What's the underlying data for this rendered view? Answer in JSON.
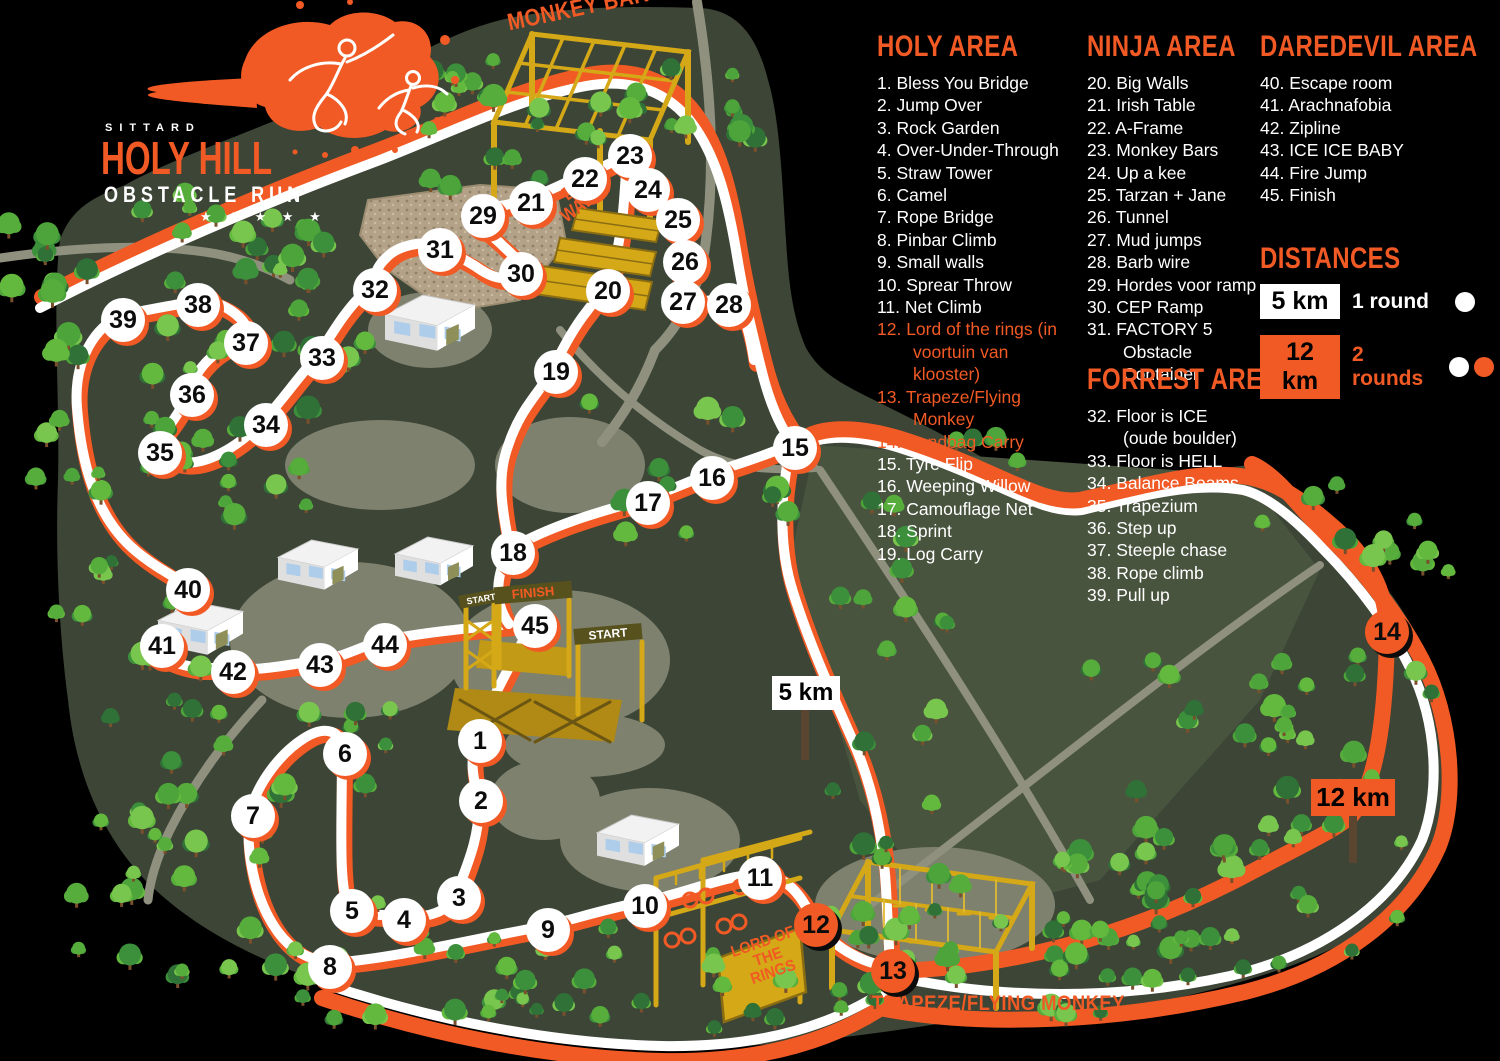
{
  "logo": {
    "city": "SITTARD",
    "title": "HOLY HILL",
    "subtitle": "OBSTACLE RUN",
    "stars": "★ ★ ★ ★ ★"
  },
  "areas": [
    {
      "title": "HOLY AREA",
      "items": [
        {
          "n": "1.",
          "t": "Bless You Bridge",
          "hl": false
        },
        {
          "n": "2.",
          "t": "Jump Over",
          "hl": false
        },
        {
          "n": "3.",
          "t": "Rock Garden",
          "hl": false
        },
        {
          "n": "4.",
          "t": "Over-Under-Through",
          "hl": false
        },
        {
          "n": "5.",
          "t": "Straw Tower",
          "hl": false
        },
        {
          "n": "6.",
          "t": "Camel",
          "hl": false
        },
        {
          "n": "7.",
          "t": "Rope Bridge",
          "hl": false
        },
        {
          "n": "8.",
          "t": "Pinbar Climb",
          "hl": false
        },
        {
          "n": "9.",
          "t": "Small walls",
          "hl": false
        },
        {
          "n": "10.",
          "t": "Sprear Throw",
          "hl": false
        },
        {
          "n": "11.",
          "t": "Net Climb",
          "hl": false
        },
        {
          "n": "12.",
          "t": "Lord of the rings (in voortuin van klooster)",
          "hl": true
        },
        {
          "n": "13.",
          "t": "Trapeze/Flying Monkey",
          "hl": true
        },
        {
          "n": "14.",
          "t": "Sandbag Carry",
          "hl": true
        },
        {
          "n": "15.",
          "t": "Tyre Flip",
          "hl": false
        },
        {
          "n": "16.",
          "t": "Weeping Willow",
          "hl": false
        },
        {
          "n": "17.",
          "t": "Camouflage Net",
          "hl": false
        },
        {
          "n": "18.",
          "t": "Sprint",
          "hl": false
        },
        {
          "n": "19.",
          "t": "Log Carry",
          "hl": false
        }
      ]
    },
    {
      "title": "NINJA AREA",
      "items": [
        {
          "n": "20.",
          "t": "Big Walls",
          "hl": false
        },
        {
          "n": "21.",
          "t": "Irish Table",
          "hl": false
        },
        {
          "n": "22.",
          "t": "A-Frame",
          "hl": false
        },
        {
          "n": "23.",
          "t": "Monkey Bars",
          "hl": false
        },
        {
          "n": "24.",
          "t": "Up a kee",
          "hl": false
        },
        {
          "n": "25.",
          "t": "Tarzan + Jane",
          "hl": false
        },
        {
          "n": "26.",
          "t": "Tunnel",
          "hl": false
        },
        {
          "n": "27.",
          "t": "Mud jumps",
          "hl": false
        },
        {
          "n": "28.",
          "t": "Barb wire",
          "hl": false
        },
        {
          "n": "29.",
          "t": "Hordes voor ramp",
          "hl": false
        },
        {
          "n": "30.",
          "t": "CEP Ramp",
          "hl": false
        },
        {
          "n": "31.",
          "t": "FACTORY 5 Obstacle Container",
          "hl": false
        }
      ]
    },
    {
      "title": "FORREST AREA",
      "items": [
        {
          "n": "32.",
          "t": "Floor is ICE (oude boulder)",
          "hl": false
        },
        {
          "n": "33.",
          "t": "Floor is HELL",
          "hl": false
        },
        {
          "n": "34.",
          "t": "Balance Beams",
          "hl": false
        },
        {
          "n": "35.",
          "t": "Trapezium",
          "hl": false
        },
        {
          "n": "36.",
          "t": "Step up",
          "hl": false
        },
        {
          "n": "37.",
          "t": "Steeple chase",
          "hl": false
        },
        {
          "n": "38.",
          "t": "Rope climb",
          "hl": false
        },
        {
          "n": "39.",
          "t": "Pull up",
          "hl": false
        }
      ]
    },
    {
      "title": "DAREDEVIL AREA",
      "items": [
        {
          "n": "40.",
          "t": "Escape room",
          "hl": false
        },
        {
          "n": "41.",
          "t": "Arachnafobia",
          "hl": false
        },
        {
          "n": "42.",
          "t": "Zipline",
          "hl": false
        },
        {
          "n": "43.",
          "t": "ICE ICE BABY",
          "hl": false
        },
        {
          "n": "44.",
          "t": "Fire Jump",
          "hl": false
        },
        {
          "n": "45.",
          "t": "Finish",
          "hl": false
        }
      ]
    }
  ],
  "distances": {
    "title": "DISTANCES",
    "rows": [
      {
        "km": "5 km",
        "box": "white",
        "desc": "1 round",
        "desc_color": "white",
        "dots": [
          "white"
        ]
      },
      {
        "km": "12 km",
        "box": "orange",
        "desc": "2 rounds",
        "desc_color": "orange",
        "dots": [
          "white",
          "orange"
        ]
      }
    ]
  },
  "map_labels": {
    "monkey_bars": "MONKEY BARS",
    "big_walls": "BIG\nWALLS",
    "lord_of_the_rings": "LORD OF\nTHE RINGS",
    "trapeze": "TRAPEZE/FLYING MONKEY",
    "finish": "FINISH",
    "start_left": "START",
    "start_right": "START",
    "sign_5km": "5 km",
    "sign_12km": "12 km"
  },
  "markers": [
    {
      "n": 1,
      "x": 480,
      "y": 741,
      "variant": "white"
    },
    {
      "n": 2,
      "x": 481,
      "y": 801,
      "variant": "white"
    },
    {
      "n": 3,
      "x": 459,
      "y": 898,
      "variant": "white"
    },
    {
      "n": 4,
      "x": 404,
      "y": 920,
      "variant": "white"
    },
    {
      "n": 5,
      "x": 352,
      "y": 911,
      "variant": "white"
    },
    {
      "n": 6,
      "x": 345,
      "y": 754,
      "variant": "white"
    },
    {
      "n": 7,
      "x": 253,
      "y": 816,
      "variant": "white"
    },
    {
      "n": 8,
      "x": 330,
      "y": 967,
      "variant": "white"
    },
    {
      "n": 9,
      "x": 548,
      "y": 930,
      "variant": "white"
    },
    {
      "n": 10,
      "x": 645,
      "y": 906,
      "variant": "white"
    },
    {
      "n": 11,
      "x": 760,
      "y": 878,
      "variant": "white"
    },
    {
      "n": 12,
      "x": 816,
      "y": 925,
      "variant": "orange"
    },
    {
      "n": 13,
      "x": 893,
      "y": 971,
      "variant": "orange"
    },
    {
      "n": 14,
      "x": 1387,
      "y": 632,
      "variant": "orange"
    },
    {
      "n": 15,
      "x": 795,
      "y": 448,
      "variant": "white"
    },
    {
      "n": 16,
      "x": 712,
      "y": 478,
      "variant": "white"
    },
    {
      "n": 17,
      "x": 648,
      "y": 503,
      "variant": "white"
    },
    {
      "n": 18,
      "x": 513,
      "y": 553,
      "variant": "white"
    },
    {
      "n": 19,
      "x": 556,
      "y": 372,
      "variant": "white"
    },
    {
      "n": 20,
      "x": 608,
      "y": 291,
      "variant": "white"
    },
    {
      "n": 21,
      "x": 531,
      "y": 203,
      "variant": "white"
    },
    {
      "n": 22,
      "x": 585,
      "y": 179,
      "variant": "white"
    },
    {
      "n": 23,
      "x": 630,
      "y": 156,
      "variant": "white"
    },
    {
      "n": 24,
      "x": 648,
      "y": 190,
      "variant": "white"
    },
    {
      "n": 25,
      "x": 678,
      "y": 220,
      "variant": "white"
    },
    {
      "n": 26,
      "x": 685,
      "y": 262,
      "variant": "white"
    },
    {
      "n": 27,
      "x": 683,
      "y": 302,
      "variant": "white"
    },
    {
      "n": 28,
      "x": 729,
      "y": 305,
      "variant": "white"
    },
    {
      "n": 29,
      "x": 483,
      "y": 216,
      "variant": "white"
    },
    {
      "n": 30,
      "x": 521,
      "y": 274,
      "variant": "white"
    },
    {
      "n": 31,
      "x": 440,
      "y": 250,
      "variant": "white"
    },
    {
      "n": 32,
      "x": 375,
      "y": 290,
      "variant": "white"
    },
    {
      "n": 33,
      "x": 322,
      "y": 358,
      "variant": "white"
    },
    {
      "n": 34,
      "x": 266,
      "y": 425,
      "variant": "white"
    },
    {
      "n": 35,
      "x": 160,
      "y": 453,
      "variant": "white"
    },
    {
      "n": 36,
      "x": 192,
      "y": 395,
      "variant": "white"
    },
    {
      "n": 37,
      "x": 246,
      "y": 343,
      "variant": "white"
    },
    {
      "n": 38,
      "x": 198,
      "y": 305,
      "variant": "white"
    },
    {
      "n": 39,
      "x": 123,
      "y": 320,
      "variant": "white"
    },
    {
      "n": 40,
      "x": 188,
      "y": 590,
      "variant": "white"
    },
    {
      "n": 41,
      "x": 162,
      "y": 646,
      "variant": "white"
    },
    {
      "n": 42,
      "x": 233,
      "y": 672,
      "variant": "white"
    },
    {
      "n": 43,
      "x": 320,
      "y": 665,
      "variant": "white"
    },
    {
      "n": 44,
      "x": 385,
      "y": 645,
      "variant": "white"
    },
    {
      "n": 45,
      "x": 535,
      "y": 626,
      "variant": "white"
    }
  ],
  "colors": {
    "orange": "#f15a24",
    "trail_white": "#ffffff",
    "map_green": "#3c4536",
    "field_green": "#49543f",
    "patch_gray": "#7e816e",
    "path_gray": "#8f907e",
    "structure_yellow": "#d4a816",
    "structure_dark": "#8a6d12",
    "rock_tan": "#b3a288",
    "background": "#000000"
  }
}
